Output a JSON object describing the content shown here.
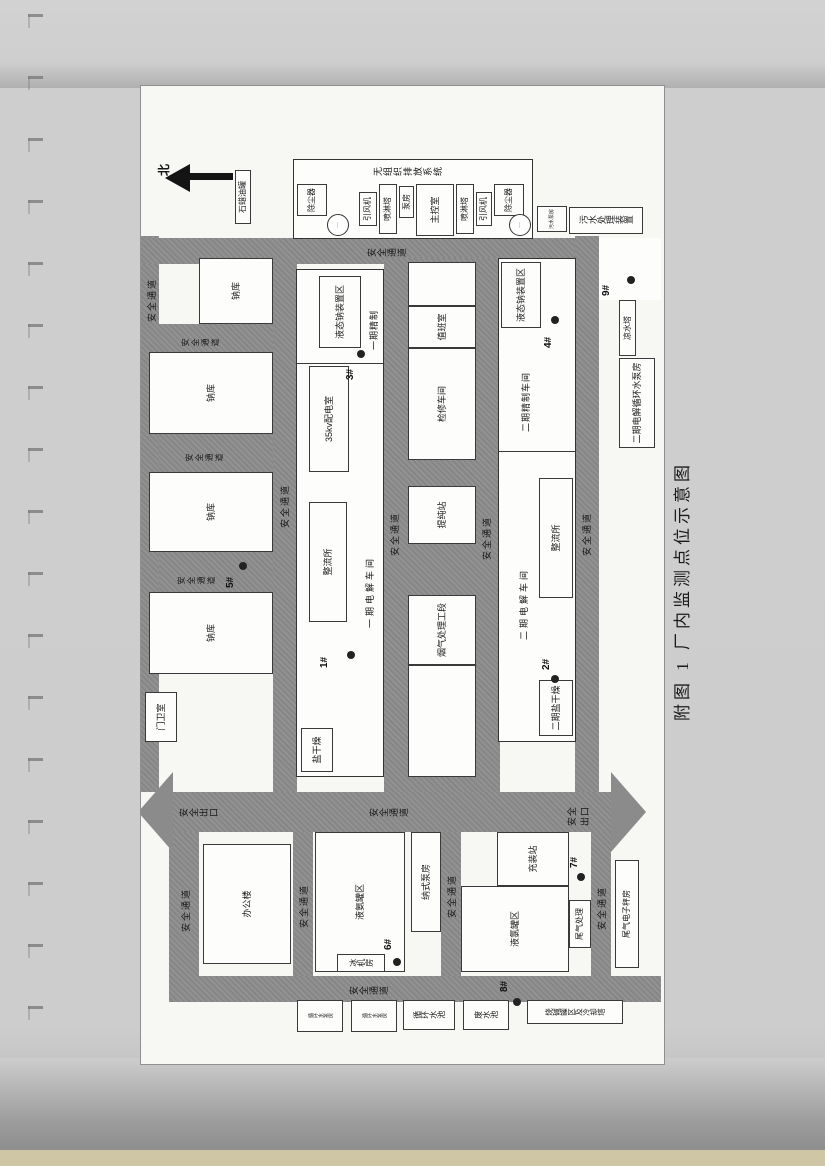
{
  "caption": "附图 1  厂内监测点位示意图",
  "compass": {
    "north": "北"
  },
  "roads": {
    "passage": "安全通道",
    "exit": "安全出口"
  },
  "monitoring_points": {
    "p1": "1#",
    "p2": "2#",
    "p3": "3#",
    "p4": "4#",
    "p5": "5#",
    "p6": "6#",
    "p7": "7#",
    "p8": "8#",
    "p9": "9#"
  },
  "buildings": {
    "paraffin_tank": "石蜡油罐",
    "sodium_warehouse": "钠库",
    "guard_room": "门卫室",
    "office": "办公楼",
    "phase1_workshop": "一期电解车间",
    "phase1_refining": "一期精制",
    "salt_drying": "盐干燥",
    "rectifier": "整流所",
    "kv_room": "35kv配电室",
    "liquid_sodium_area": "液态钠装置区",
    "flue_gas_section": "烟气处理工段",
    "purification_station": "提纯站",
    "maintenance_shop": "检修车间",
    "duty_room": "值班室",
    "phase2_workshop": "二期电解车间",
    "phase2_refining": "二期精制车间",
    "phase2_salt_drying": "二期盐干燥",
    "ammonia_tank_area": "液氨罐区",
    "ice_machine_room": "冰机房",
    "nash_pump_room": "纳式泵房",
    "chlorine_tank_area": "液氯罐区",
    "filling_station": "充装站",
    "tail_gas_treatment": "尾气处理",
    "tail_gas_scale_room": "尾气电子秤房",
    "circulating_pump_room": "循环水泵房",
    "circulating_pool": "循环水池",
    "waste_water_pool": "废水池",
    "caustic_tank_area": "烧碱罐区及冷却塔",
    "cooling_tower": "凉水塔",
    "phase2_circ_pump_room": "二期电解循环水泵房",
    "sewage_pump_room": "污水泵房",
    "sewage_treatment": "污水处理装置"
  },
  "fugitive_system": {
    "title": "无组织排放系统",
    "dust_collector": "除尘器",
    "draft_fan": "引风机",
    "spray_tower": "喷淋塔",
    "pump_room": "泵房",
    "control_room": "主控室",
    "stack_glyph": "···"
  }
}
